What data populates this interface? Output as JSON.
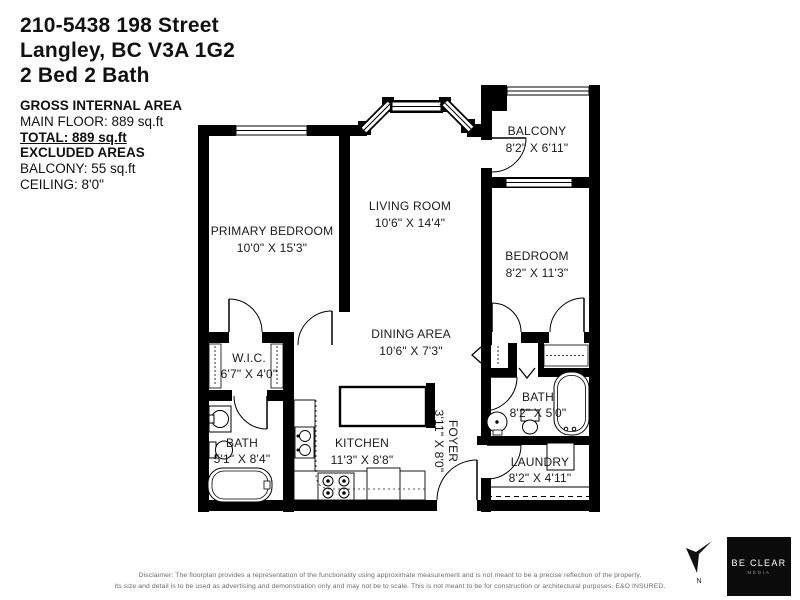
{
  "header": {
    "address_line1": "210-5438 198 Street",
    "address_line2": "Langley, BC V3A 1G2",
    "address_line3": "2 Bed 2 Bath"
  },
  "area_summary": {
    "title": "GROSS INTERNAL AREA",
    "main_floor": "MAIN FLOOR: 889 sq.ft",
    "total": "TOTAL: 889 sq.ft",
    "excluded_title": "EXCLUDED AREAS",
    "balcony": "BALCONY: 55 sq.ft",
    "ceiling": "CEILING: 8'0\""
  },
  "rooms": {
    "primary_bedroom": {
      "name": "PRIMARY BEDROOM",
      "dims": "10'0\" X 15'3\""
    },
    "living_room": {
      "name": "LIVING ROOM",
      "dims": "10'6\" X 14'4\""
    },
    "balcony": {
      "name": "BALCONY",
      "dims": "8'2\" X 6'11\""
    },
    "bedroom": {
      "name": "BEDROOM",
      "dims": "8'2\" X 11'3\""
    },
    "wic": {
      "name": "W.I.C.",
      "dims": "6'7\" X 4'0\""
    },
    "dining_area": {
      "name": "DINING AREA",
      "dims": "10'6\" X 7'3\""
    },
    "bath_primary": {
      "name": "BATH",
      "dims": "5'1\" X 8'4\""
    },
    "kitchen": {
      "name": "KITCHEN",
      "dims": "11'3\" X 8'8\""
    },
    "foyer": {
      "name": "FOYER",
      "dims": "3'11\" X 8'0\""
    },
    "bath_main": {
      "name": "BATH",
      "dims": "8'2\" X 5'0\""
    },
    "laundry": {
      "name": "LAUNDRY",
      "dims": "8'2\" X 4'11\""
    }
  },
  "compass": {
    "label": "N"
  },
  "logo": {
    "line1": "BE CLEAR",
    "line2": "MEDIA"
  },
  "footer": {
    "disclaimer_line1": "Disclaimer: The floorplan provides a representation of the functionality using approximate measurement and is not meant to be a precise reflection of the property,",
    "disclaimer_line2": "its size and detail is to be used as advertising and demonstration only and may not be to scale. This is not meant to be for construction or architectural purposes. E&O INSURED."
  },
  "colors": {
    "wall": "#000000",
    "background": "#ffffff",
    "label": "#1a1a1a",
    "disclaimer": "#6b6b6b"
  }
}
